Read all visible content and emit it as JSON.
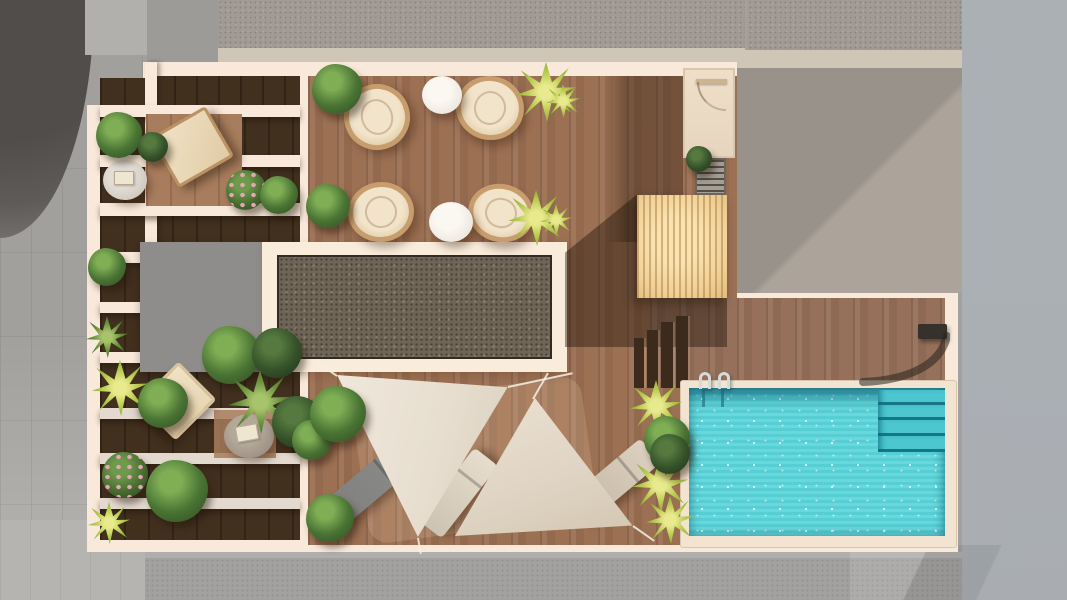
{
  "scene": {
    "description": "Aerial top-down 3D architectural render of a rooftop terrace with wooden decking, a pergola lounge, a dining area, a skylight, triangular shade sails over sun loungers, and a turquoise swimming pool, surrounded by gray neighboring rooftops and streets",
    "view": "top-down aerial",
    "lighting": "bright daylight with warm shadows"
  },
  "areas": {
    "dining_area": {
      "material": "wood plank deck",
      "chairs": 4,
      "round_tables": 2,
      "chair_style": "round rattan with cream cushion"
    },
    "pergola_lounge_left": {
      "beam_orientation": "horizontal white beams",
      "loungers": 2,
      "side_tables": 2,
      "planting_bands": 6
    },
    "skylight": {
      "frame": "cream",
      "fill": "dark speckled glass/gravel"
    },
    "service_roof": {
      "shape": "flat gray rectangle"
    },
    "shade_sail_area": {
      "sails": 2,
      "sail_shape": "triangle",
      "loungers": 3,
      "lounger_colors": [
        "gray",
        "cream",
        "tan"
      ]
    },
    "pool_area": {
      "pools": 1,
      "ladders": 1,
      "submerged_steps": 4,
      "outdoor_showers": 1,
      "deck": "wood planks"
    },
    "pergola_cube": {
      "material": "light slatted wood",
      "stair_treads": 4
    },
    "utility": {
      "door_rooms": 1,
      "floor_grates": 1
    }
  },
  "plants": {
    "green_shrubs": 14,
    "dark_shrubs": 5,
    "yellow_palms": 10,
    "flowering_shrubs": 2
  },
  "colors": {
    "cream": "#f8e9da",
    "wood_mid": "#9c7053",
    "wood_deep": "#42301f",
    "wood_pool": "#96705a",
    "wood_light": "#a87d5d",
    "gray_flat": "#8f8d8b",
    "sky_frame": "#f9ecdb",
    "sky_fill": "#6f6557",
    "pergola": "#f0d096",
    "pool": "#5cd5d9",
    "pool_step": "#4cc6cf",
    "sail_a": "#e7ded0",
    "sail_b": "#e0d5c4",
    "street": "#a2a09d",
    "street_light": "#b7b5b2",
    "roof_gravel": "#a19b94",
    "roof_edge": "#d0c6b8",
    "roof_warm": "#99928a",
    "roof_warm_light": "#aca49a",
    "roof_cool": "#a9adb2",
    "roof_bottom": "#a3a19f",
    "dark_round": "#5e5b58",
    "chair_frame": "#c79d6d",
    "cushion": "#f2e4cb",
    "table_white": "#ece8df",
    "table_gray": "#9d9184",
    "lounger_gray": "#8c8c8a",
    "lounger_cream": "#e6ddcd",
    "lounger_tan": "#dcd0bf",
    "plant_green": "#4a7434",
    "plant_dark": "#35522a",
    "plant_yellow": "#b9cc50",
    "plant_pink": "#e3a7b4",
    "door_floor": "#e6d5bf",
    "grate": "#a59e93",
    "steps_dark": "#3c2b1c"
  }
}
